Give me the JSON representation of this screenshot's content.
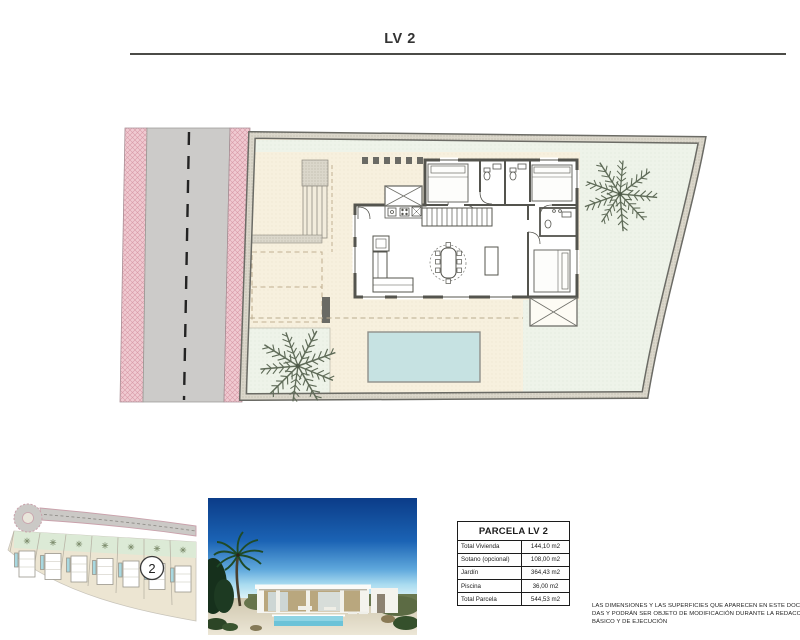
{
  "page": {
    "title": "LV 2"
  },
  "parcel_table": {
    "title": "PARCELA LV 2",
    "rows": [
      {
        "label": "Total Vivienda",
        "value": "144,10 m2"
      },
      {
        "label": "Sotano (opcional)",
        "value": "108,00 m2"
      },
      {
        "label": "Jardín",
        "value": "364,43 m2"
      },
      {
        "label": "Piscina",
        "value": "36,00 m2"
      },
      {
        "label": "Total Parcela",
        "value": "544,53 m2"
      }
    ]
  },
  "site_map": {
    "highlight_plot_label": "2"
  },
  "disclaimer": {
    "lines": [
      "LAS DIMENSIONES Y LAS SUPERFICIES QUE APARECEN EN ESTE DOCUMENTO SON",
      "DAS Y PODRÁN SER OBJETO DE MODIFICACIÓN DURANTE LA REDACCIÓN DE LOS",
      "BÁSICO Y DE EJECUCIÓN"
    ]
  },
  "colors": {
    "road_pink": "#f0cad1",
    "road_gray": "#cccbc9",
    "plot_border": "#6b6b65",
    "garden_mint": "#eef3e9",
    "terrace_cream": "#f7f0de",
    "pool_blue": "#c6e2e2",
    "wall_gray": "#54544e",
    "sky_blue": "#0b3c88"
  }
}
